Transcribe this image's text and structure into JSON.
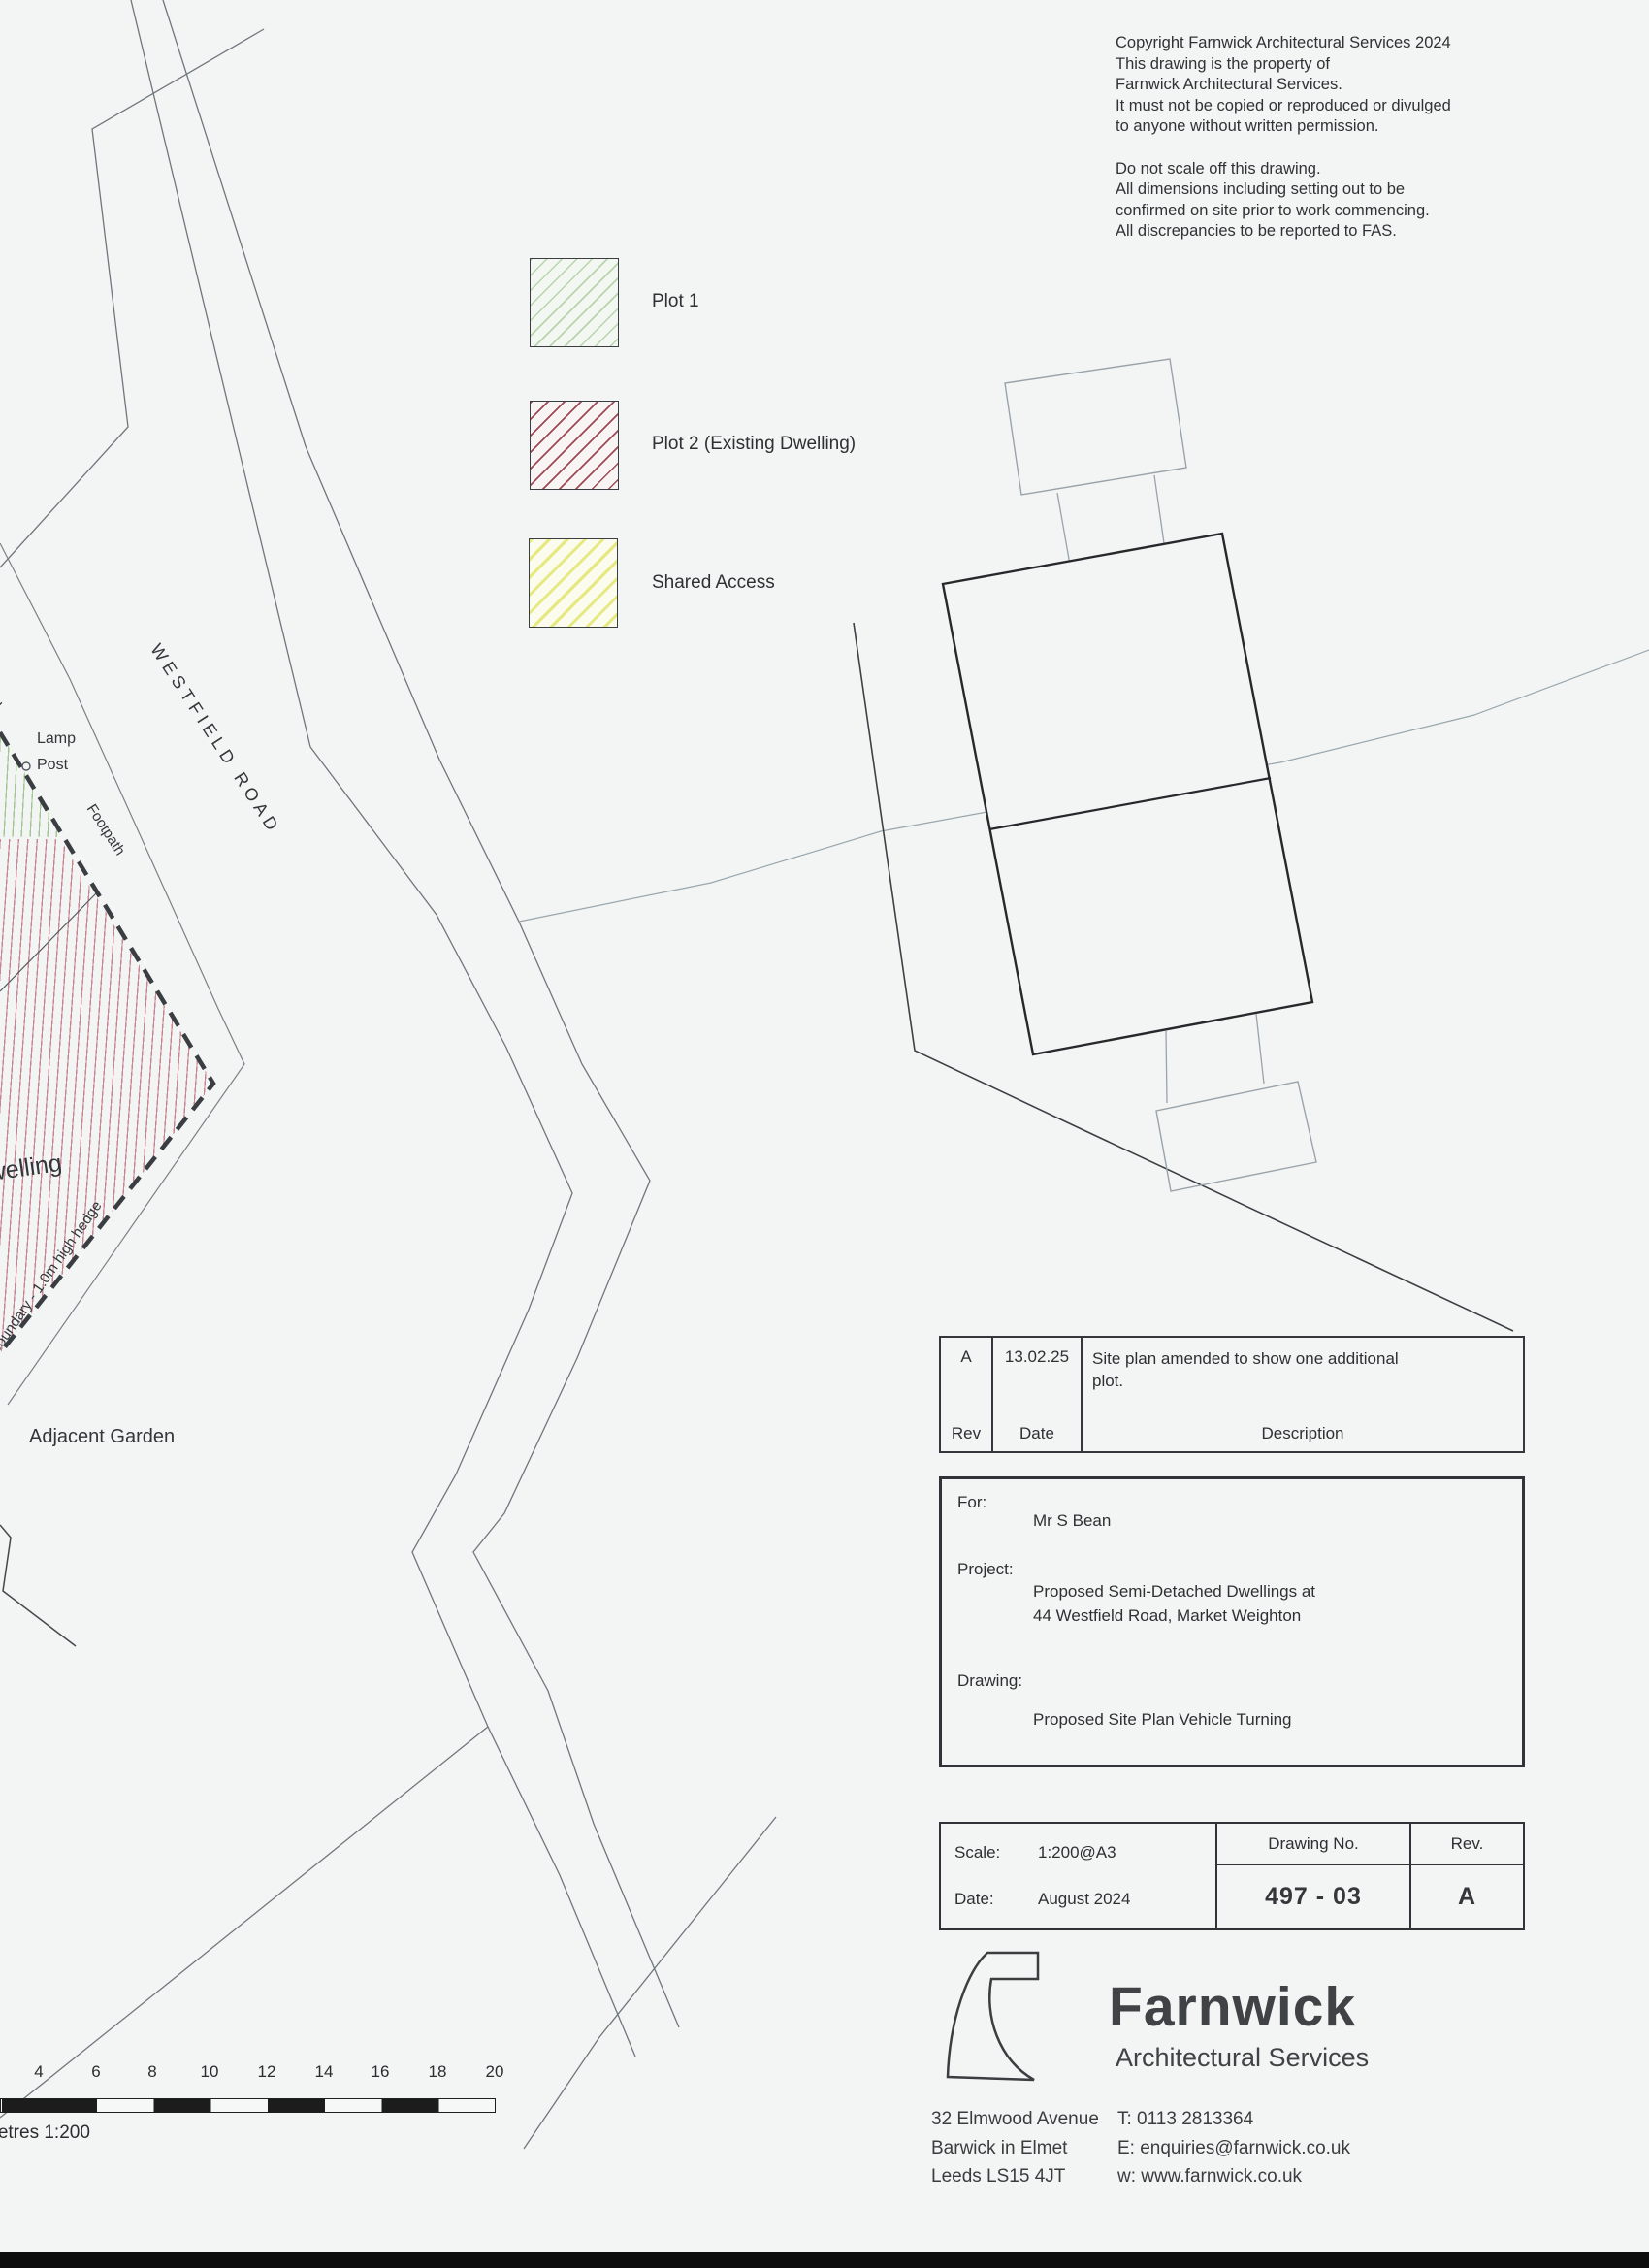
{
  "copyright": {
    "lines": [
      "Copyright Farnwick Architectural Services 2024",
      "This drawing is the property of",
      "Farnwick Architectural Services.",
      "It must not be copied or reproduced or divulged",
      "to anyone without written permission.",
      "Do not scale off this drawing.",
      "All dimensions including setting out to be",
      "confirmed on site prior to work commencing.",
      "All discrepancies to be reported to FAS."
    ]
  },
  "legend": {
    "items": [
      {
        "label": "Plot 1",
        "hatch_color": "#b9d3ad"
      },
      {
        "label": "Plot 2 (Existing Dwelling)",
        "hatch_color": "#9e4a56"
      },
      {
        "label": "Shared Access",
        "hatch_color": "#e6e880"
      }
    ]
  },
  "plan_labels": {
    "road": "WESTFIELD ROAD",
    "footpath": "Footpath",
    "lamp_line1": "Lamp",
    "lamp_line2": "Post",
    "wall": "wall",
    "dwelling": "Dwelling",
    "boundary_hedge": "Boundary - 1.0m high hedge",
    "adjacent_garden": "Adjacent Garden"
  },
  "revision_table": {
    "headers": {
      "rev": "Rev",
      "date": "Date",
      "description": "Description"
    },
    "row": {
      "rev": "A",
      "date": "13.02.25",
      "description": "Site plan amended to show one additional plot."
    }
  },
  "title_block": {
    "for_label": "For:",
    "for_value": "Mr S Bean",
    "project_label": "Project:",
    "project_line1": "Proposed Semi-Detached Dwellings at",
    "project_line2": "44 Westfield Road, Market Weighton",
    "drawing_label": "Drawing:",
    "drawing_value": "Proposed Site Plan Vehicle Turning"
  },
  "info_table": {
    "scale_label": "Scale:",
    "scale_value": "1:200@A3",
    "date_label": "Date:",
    "date_value": "August 2024",
    "drawing_no_label": "Drawing No.",
    "drawing_no_value": "497 - 03",
    "rev_label": "Rev.",
    "rev_value": "A"
  },
  "brand": {
    "name": "Farnwick",
    "tagline": "Architectural Services",
    "address_lines": [
      "32 Elmwood Avenue",
      "Barwick in Elmet",
      "Leeds LS15 4JT"
    ],
    "contact_lines": [
      "T: 0113 2813364",
      "E: enquiries@farnwick.co.uk",
      "w: www.farnwick.co.uk"
    ]
  },
  "scale_bar": {
    "ticks": [
      "4",
      "6",
      "8",
      "10",
      "12",
      "14",
      "16",
      "18",
      "20"
    ],
    "caption": "Metres 1:200"
  },
  "colors": {
    "paper": "#f2f5f3",
    "line_thin": "#6f767d",
    "line_dark": "#26292c",
    "boundary_dash": "#3a3e43",
    "vehicle_line": "#9aa3ab"
  }
}
